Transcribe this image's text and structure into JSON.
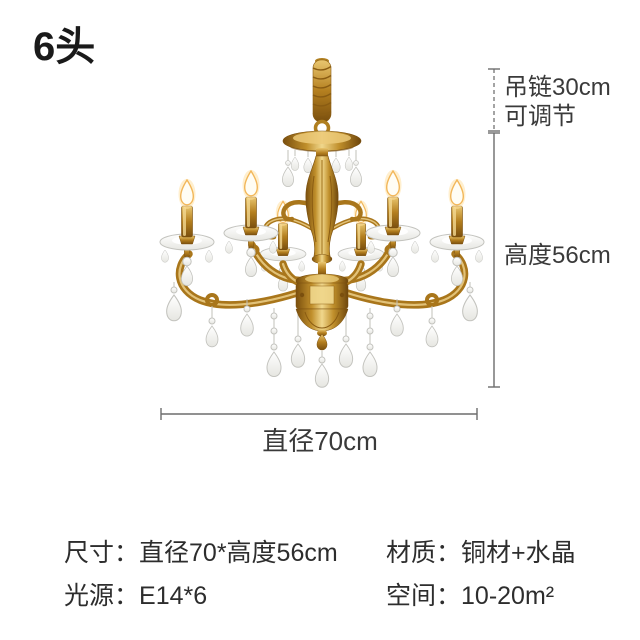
{
  "header": {
    "title": "6头"
  },
  "dimensions": {
    "chain_line1": "吊链30cm",
    "chain_line2": "可调节",
    "height": "高度56cm",
    "diameter": "直径70cm"
  },
  "specs": {
    "left": [
      {
        "label": "尺寸：",
        "value": "直径70*高度56cm"
      },
      {
        "label": "光源：",
        "value": "E14*6"
      }
    ],
    "right": [
      {
        "label": "材质：",
        "value": "铜材+水晶"
      },
      {
        "label": "空间：",
        "value": "10-20m²"
      }
    ]
  },
  "colors": {
    "text_primary": "#2d2d2d",
    "dimension_text": "#3a3a3a",
    "dimension_line": "#6d6d6d",
    "brass_gold": "#c9952c",
    "crystal": "#f2f2ef",
    "background": "#ffffff"
  }
}
